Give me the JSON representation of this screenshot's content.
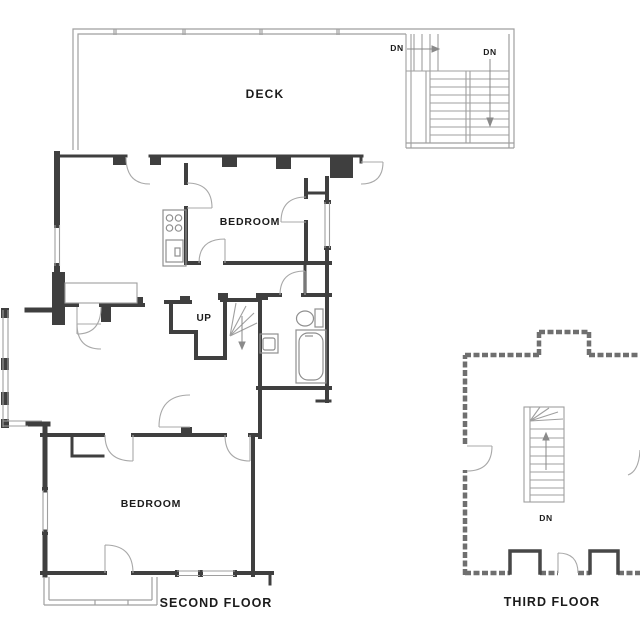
{
  "drawing": {
    "type": "architectural floor plan",
    "background": "#ffffff",
    "colors": {
      "wall": "#3f3f3f",
      "thin_line": "#9f9f9f",
      "arc_line": "#a8a8a8",
      "dashed_wall": "#6f6f6f",
      "text": "#1b1b1b"
    }
  },
  "labels": {
    "deck": "DECK",
    "dn_deck_upper": "DN",
    "dn_deck_lower": "DN",
    "bedroom_top": "BEDROOM",
    "up": "UP",
    "bedroom_bottom": "BEDROOM",
    "second_floor_caption": "SECOND FLOOR",
    "dn_third": "DN",
    "third_floor_caption": "THIRD FLOOR"
  }
}
